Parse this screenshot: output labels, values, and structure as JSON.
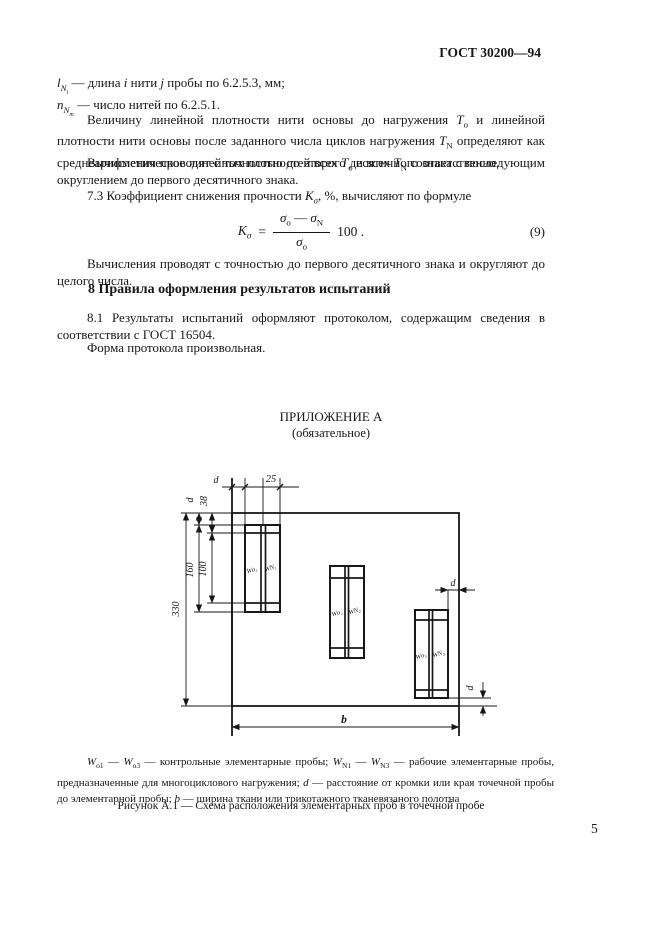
{
  "colors": {
    "ink": "#171717",
    "paper": "#ffffff"
  },
  "header": {
    "doc_code": "ГОСТ 30200—94",
    "page_number": "5"
  },
  "definitions": {
    "d1": {
      "sym": "l",
      "sub": "N",
      "subsub": "i",
      "t1": " — длина ",
      "it1": "i",
      "t2": " нити ",
      "it2": "j",
      "t3": " пробы по 6.2.5.3, мм;"
    },
    "d2": {
      "sym": "n",
      "sub": "N",
      "subsub": "т",
      "t1": " — число нитей по 6.2.5.1."
    }
  },
  "para_density": {
    "t1": "Величину линейной плотности нити основы до нагружения ",
    "v1": "T",
    "v1s": "о",
    "t2": " и линейной плотности нити основы после заданного числа циклов нагружения ",
    "v2": "T",
    "v2s": "N",
    "t3": " определяют как среднеарифметическое линейных плотностей всех ",
    "v3": "T",
    "v3s": "о",
    "t4": " и всех ",
    "v4": "T",
    "v4s": "N",
    "t5": " соответственно."
  },
  "para_round2": "Вычисления проводят с точностью до второго десятичного знака с последующим округлением до первого десятичного знака.",
  "line73": {
    "t1": "7.3  Коэффициент снижения прочности ",
    "sym": "K",
    "sub": "σ",
    "t2": ", %, вычисляют по формуле"
  },
  "formula": {
    "lhs": "K",
    "lhs_sub": "σ",
    "eq": "=",
    "num_a": "σ",
    "num_a_sub": "о",
    "minus": "—",
    "num_b": "σ",
    "num_b_sub": "N",
    "den": "σ",
    "den_sub": "о",
    "factor": "100 .",
    "number": "(9)"
  },
  "para_round1": "Вычисления проводят с точностью до первого десятичного знака и округляют до целого числа.",
  "section8": {
    "heading": "8  Правила оформления результатов испытаний",
    "p81": "8.1  Результаты испытаний оформляют протоколом, содержащим сведения в соответствии с ГОСТ  16504.",
    "p82": "Форма протокола произвольная."
  },
  "appendix": {
    "title": "ПРИЛОЖЕНИЕ А",
    "subtitle": "(обязательное)"
  },
  "figure": {
    "dims": {
      "top_d": "d",
      "top_25": "25",
      "left_d": "d",
      "left_38": "38",
      "left_160": "160",
      "left_100": "100",
      "left_330": "330",
      "right_d": "d",
      "bottom_d": "d",
      "width_b": "b"
    },
    "samples": [
      {
        "o": "Wо₁",
        "n": "WN₁"
      },
      {
        "o": "Wо₂",
        "n": "WN₂"
      },
      {
        "o": "Wо₃",
        "n": "WN₃"
      }
    ],
    "caption": {
      "wa": "W",
      "was": "о1",
      "d1": " — ",
      "wb": "W",
      "wbs": "о3",
      "t1": " — контрольные элементарные пробы; ",
      "wc": "W",
      "wcs": "N1",
      "d2": " — ",
      "wd": "W",
      "wds": "N3",
      "t2": " — рабочие элементарные пробы, предназначенные для многоциклового нагружения; ",
      "vd": "d",
      "t3": " — расстояние от кромки или края точечной пробы до элементарной пробы; ",
      "vb": "b",
      "t4": " — ширина ткани или трикотажного тканевязаного полотна"
    },
    "label": "Рисунок  А.1 — Схема расположения элементарных проб в точечной пробе"
  }
}
